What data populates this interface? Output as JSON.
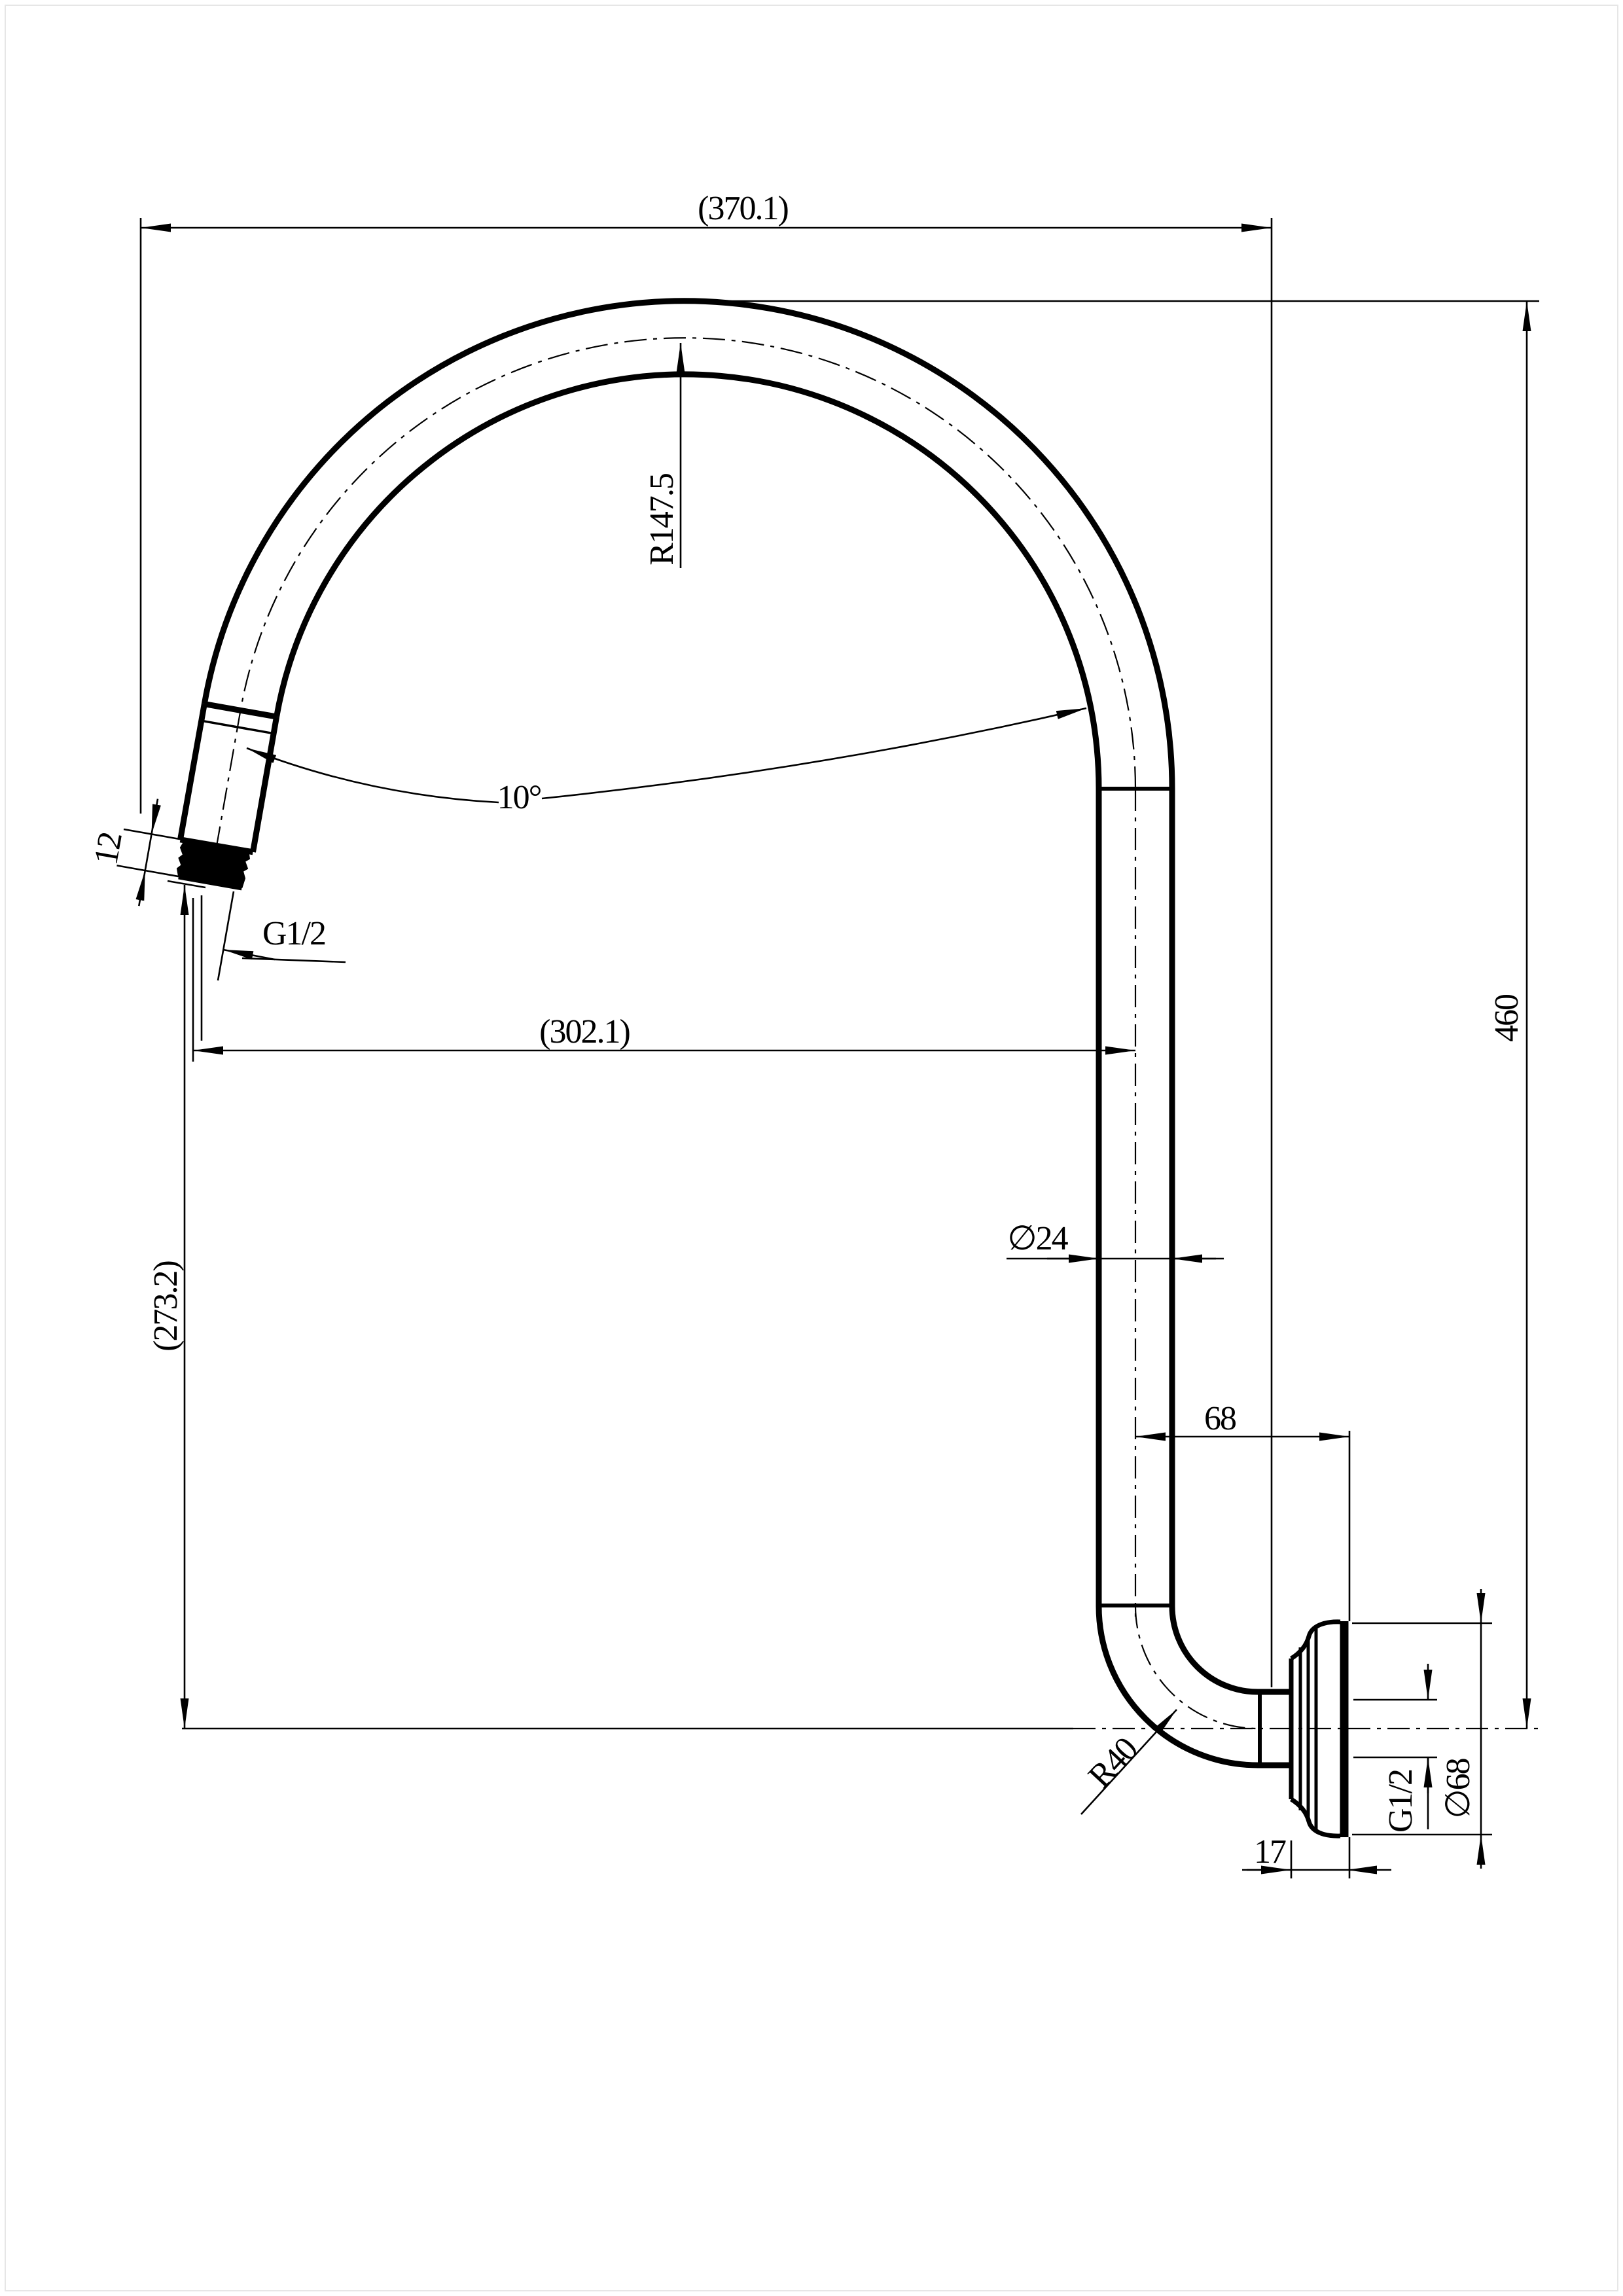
{
  "page": {
    "background": "#ffffff",
    "line_color": "#000000"
  },
  "drawing": {
    "type": "technical-drawing",
    "subject": "wall-mounted gooseneck shower arm, side elevation",
    "dimensions": {
      "overall_width": "(370.1)",
      "overall_height": "460",
      "spout_reach": "(302.1)",
      "spout_drop": "(273.2)",
      "bend_radius": "R147.5",
      "outlet_angle": "10°",
      "outlet_thread_length": "12",
      "outlet_thread": "G1/2",
      "pipe_diameter": "∅24",
      "wall_offset": "68",
      "elbow_radius": "R40",
      "inlet_thread": "G1/2",
      "flange_diameter": "∅68",
      "flange_depth": "17"
    }
  }
}
